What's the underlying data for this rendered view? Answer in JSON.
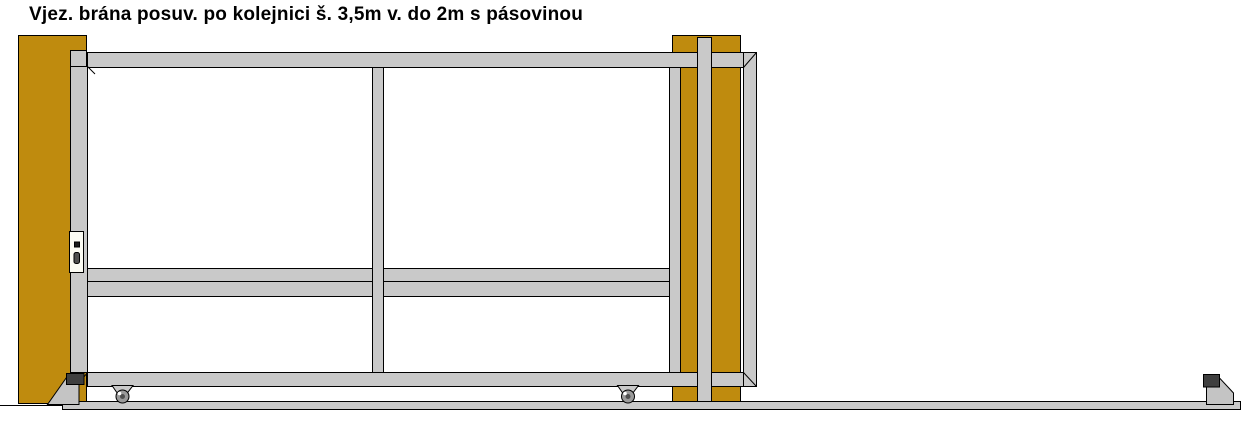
{
  "title": "Vjez. brána posuv. po kolejnici š. 3,5m v. do 2m s pásovinou",
  "colors": {
    "background": "#FFFFFF",
    "post": "#BF8B0E",
    "frame": "#C9C9C9",
    "pedestal": "#C4C4C4",
    "catch_block": "#3F3F3F",
    "wheel": "#9A9A9A",
    "wheel_hub": "#4F4F4F",
    "wheel_highlight": "#FFFFFF",
    "lock_body": "#FCFCF4",
    "lock_detail": "#1A1A1A",
    "outline": "#000000"
  }
}
